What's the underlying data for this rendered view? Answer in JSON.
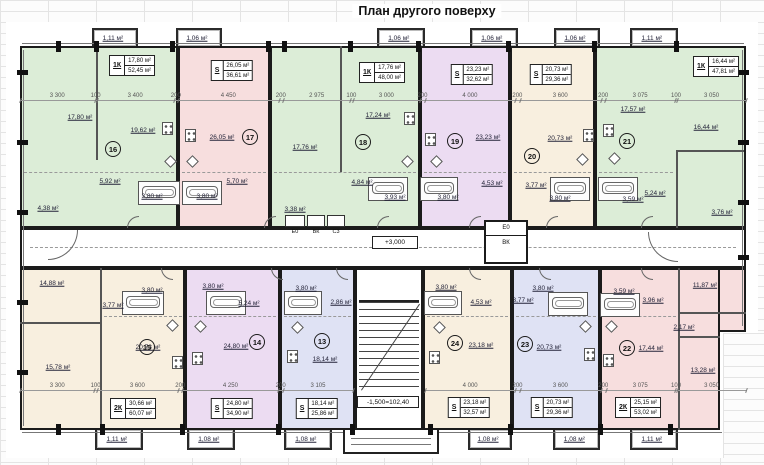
{
  "title": "План другого поверху",
  "marks": {
    "corridor_level": "+3,000",
    "stair_level": "-1,500=102,40"
  },
  "riser_labels": [
    "Е0",
    "ВК",
    "С3"
  ],
  "elevator_shaft": {
    "top": "Е0",
    "bottom": "ВК"
  },
  "colors": {
    "green": "#dcedd7",
    "pink": "#f7dede",
    "lavender": "#ecdcf2",
    "cream": "#f8efdf",
    "blue": "#dfe2f4",
    "wall": "#1b1b1b"
  },
  "dims": {
    "top": [
      "3 300",
      "100",
      "3 400",
      "200",
      "4 450",
      "200",
      "2 975",
      "100",
      "3 000",
      "200",
      "4 000",
      "200",
      "3 600",
      "200",
      "3 075",
      "100",
      "3 050"
    ],
    "bottom_left": [
      "3 300",
      "100",
      "3 600",
      "200",
      "4 250",
      "200",
      "3 105"
    ],
    "bottom_right": [
      "4 000",
      "200",
      "3 600",
      "200",
      "3 075",
      "100",
      "3 050"
    ]
  },
  "units": [
    {
      "num": "16",
      "type": "1К",
      "area_living": "17,80 м²",
      "area_total": "52,45 м²",
      "color": "green",
      "balcony": "1,11 м²",
      "rooms": [
        "17,80 м²",
        "19,62 м²",
        "5,92 м²",
        "3,80 м²",
        "4,38 м²"
      ]
    },
    {
      "num": "17",
      "type": "S",
      "area_living": "26,05 м²",
      "area_total": "36,61 м²",
      "color": "pink",
      "balcony": "1,06 м²",
      "rooms": [
        "26,05 м²",
        "5,70 м²",
        "3,80 м²"
      ]
    },
    {
      "num": "18",
      "type": "1К",
      "area_living": "17,76 м²",
      "area_total": "48,00 м²",
      "color": "green",
      "balcony": "1,06 м²",
      "rooms": [
        "17,76 м²",
        "17,24 м²",
        "4,84 м²",
        "3,93 м²",
        "3,38 м²"
      ]
    },
    {
      "num": "19",
      "type": "S",
      "area_living": "23,23 м²",
      "area_total": "32,62 м²",
      "color": "lavender",
      "balcony": "1,06 м²",
      "rooms": [
        "23,23 м²",
        "4,53 м²",
        "3,80 м²"
      ]
    },
    {
      "num": "20",
      "type": "S",
      "area_living": "20,73 м²",
      "area_total": "29,36 м²",
      "color": "cream",
      "balcony": "1,06 м²",
      "rooms": [
        "20,73 м²",
        "3,77 м²",
        "3,80 м²"
      ]
    },
    {
      "num": "21",
      "type": "1К",
      "area_living": "16,44 м²",
      "area_total": "47,81 м²",
      "color": "green",
      "balcony": "1,11 м²",
      "rooms": [
        "17,57 м²",
        "16,44 м²",
        "5,24 м²",
        "3,59 м²",
        "3,76 м²"
      ]
    },
    {
      "num": "15",
      "type": "2К",
      "area_living": "30,66 м²",
      "area_total": "60,07 м²",
      "color": "cream",
      "balcony": "1,11 м²",
      "rooms": [
        "14,88 м²",
        "15,78 м²",
        "20,73 м²",
        "3,77 м²",
        "3,80 м²"
      ]
    },
    {
      "num": "14",
      "type": "S",
      "area_living": "24,80 м²",
      "area_total": "34,90 м²",
      "color": "lavender",
      "balcony": "1,08 м²",
      "rooms": [
        "24,80 м²",
        "5,24 м²",
        "3,80 м²"
      ]
    },
    {
      "num": "13",
      "type": "S",
      "area_living": "18,14 м²",
      "area_total": "25,86 м²",
      "color": "blue",
      "balcony": "1,08 м²",
      "rooms": [
        "18,14 м²",
        "2,86 м²",
        "3,80 м²"
      ]
    },
    {
      "num": "24",
      "type": "S",
      "area_living": "23,18 м²",
      "area_total": "32,57 м²",
      "color": "cream",
      "balcony": "1,08 м²",
      "rooms": [
        "23,18 м²",
        "4,53 м²",
        "3,80 м²"
      ]
    },
    {
      "num": "23",
      "type": "S",
      "area_living": "20,73 м²",
      "area_total": "29,36 м²",
      "color": "blue",
      "balcony": "1,08 м²",
      "rooms": [
        "20,73 м²",
        "3,77 м²",
        "3,80 м²"
      ]
    },
    {
      "num": "22",
      "type": "2К",
      "area_living": "25,15 м²",
      "area_total": "53,02 м²",
      "color": "pink",
      "balcony": "1,11 м²",
      "rooms": [
        "17,44 м²",
        "11,87 м²",
        "13,28 м²",
        "2,17 м²",
        "3,96 м²",
        "3,59 м²"
      ]
    }
  ]
}
